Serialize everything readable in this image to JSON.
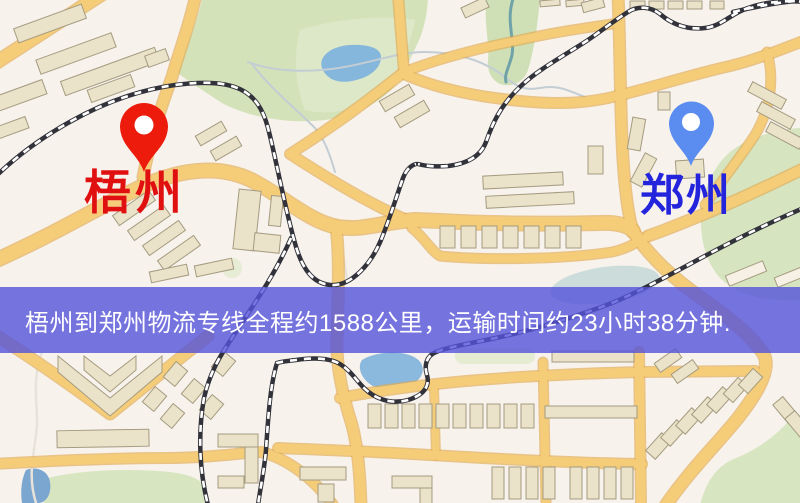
{
  "map": {
    "origin_label": "梧州",
    "destination_label": "郑州",
    "origin_label_color": "#e11010",
    "destination_label_color": "#2424dc",
    "origin_pin_color": "#ed1b0c",
    "destination_pin_color": "#5b8cf0"
  },
  "banner": {
    "text": "梧州到郑州物流专线全程约1588公里，运输时间约23小时38分钟.",
    "background_color": "rgba(84,82,219,0.80)",
    "text_color": "#ffffff"
  }
}
